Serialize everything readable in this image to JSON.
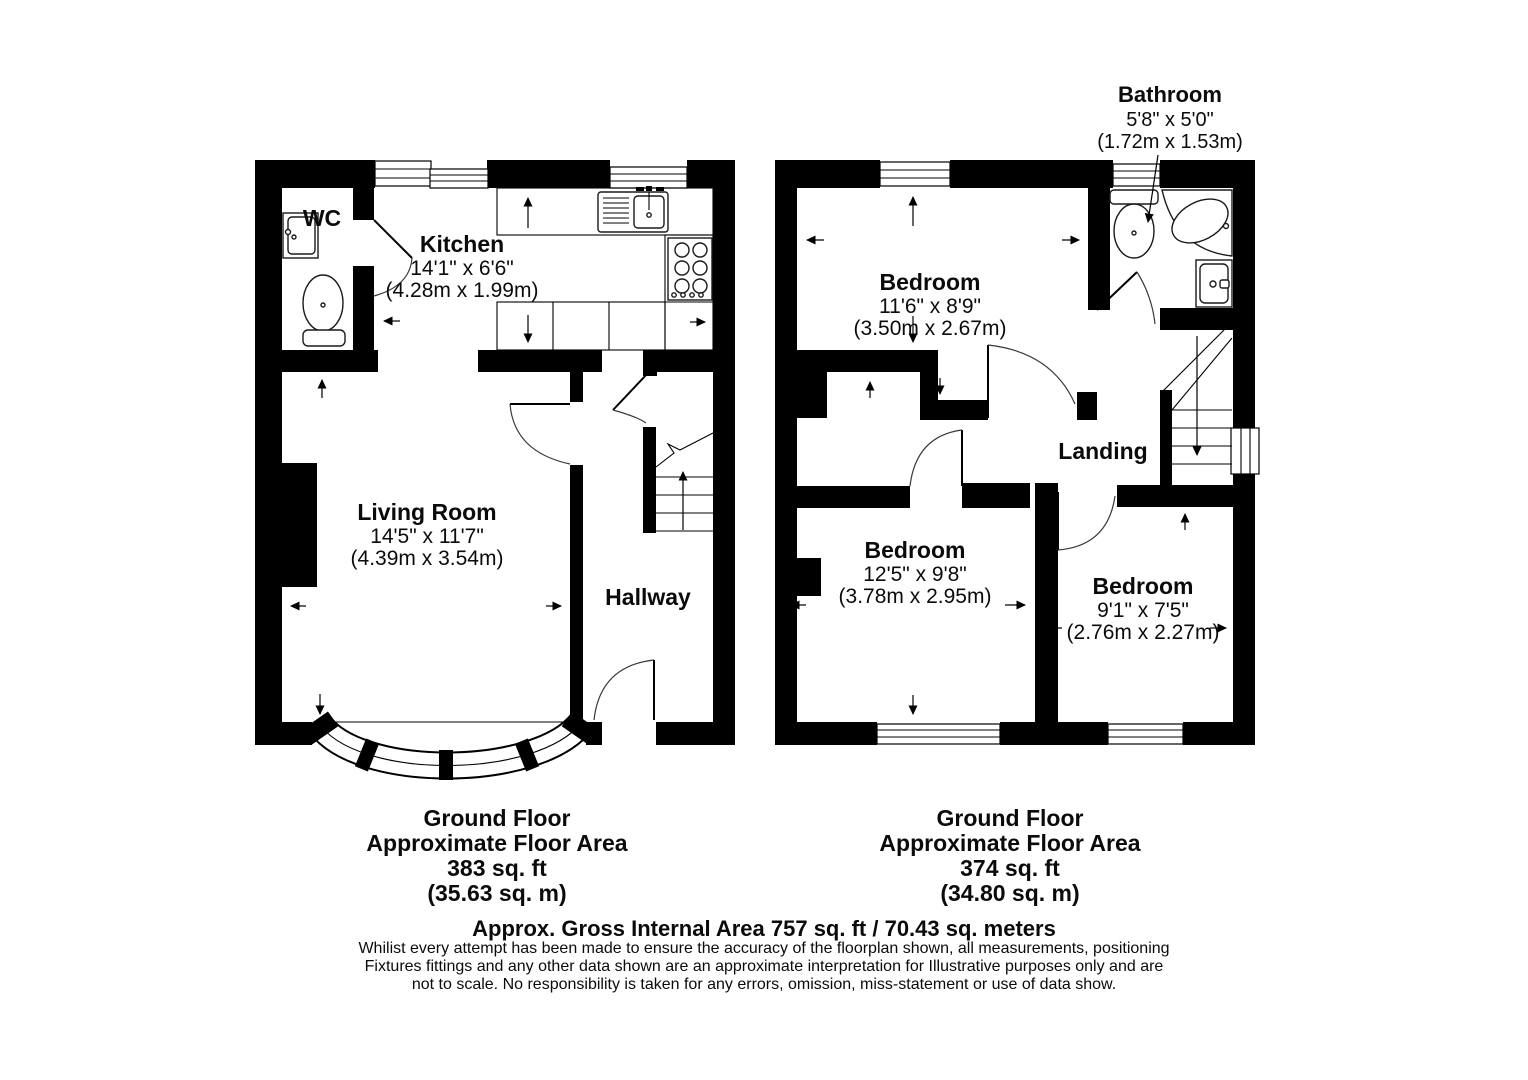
{
  "document_type": "property-floorplan",
  "colors": {
    "walls": "#000000",
    "background": "#ffffff",
    "text": "#0b0b0b"
  },
  "plans": {
    "left": {
      "rooms": {
        "wc": {
          "name": "WC"
        },
        "kitchen": {
          "name": "Kitchen",
          "imperial": "14'1\" x 6'6\"",
          "metric": "(4.28m x 1.99m)"
        },
        "living_room": {
          "name": "Living Room",
          "imperial": "14'5\" x 11'7\"",
          "metric": "(4.39m x 3.54m)"
        },
        "hallway": {
          "name": "Hallway"
        }
      },
      "footer": {
        "title": "Ground Floor",
        "subtitle": "Approximate Floor Area",
        "area_imperial": "383 sq. ft",
        "area_metric": "(35.63 sq. m)"
      }
    },
    "right": {
      "rooms": {
        "bathroom": {
          "name": "Bathroom",
          "imperial": "5'8\" x 5'0\"",
          "metric": "(1.72m x 1.53m)"
        },
        "bedroom_front": {
          "name": "Bedroom",
          "imperial": "11'6\" x 8'9\"",
          "metric": "(3.50m x 2.67m)"
        },
        "landing": {
          "name": "Landing"
        },
        "bedroom_middle": {
          "name": "Bedroom",
          "imperial": "12'5\" x 9'8\"",
          "metric": "(3.78m x 2.95m)"
        },
        "bedroom_back": {
          "name": "Bedroom",
          "imperial": "9'1\" x 7'5\"",
          "metric": "(2.76m x 2.27m)"
        }
      },
      "footer": {
        "title": "Ground Floor",
        "subtitle": "Approximate Floor Area",
        "area_imperial": "374 sq. ft",
        "area_metric": "(34.80 sq. m)"
      }
    }
  },
  "summary": {
    "gross_area": "Approx. Gross Internal Area 757 sq. ft / 70.43 sq. meters",
    "disclaimer_line1": "Whilist every attempt has been made to ensure the accuracy of the floorplan shown, all measurements, positioning",
    "disclaimer_line2": "Fixtures fittings and any other data shown are an approximate interpretation for Illustrative purposes only  and are",
    "disclaimer_line3": "not to scale. No responsibility is taken for any errors, omission, miss-statement or use of data show."
  }
}
